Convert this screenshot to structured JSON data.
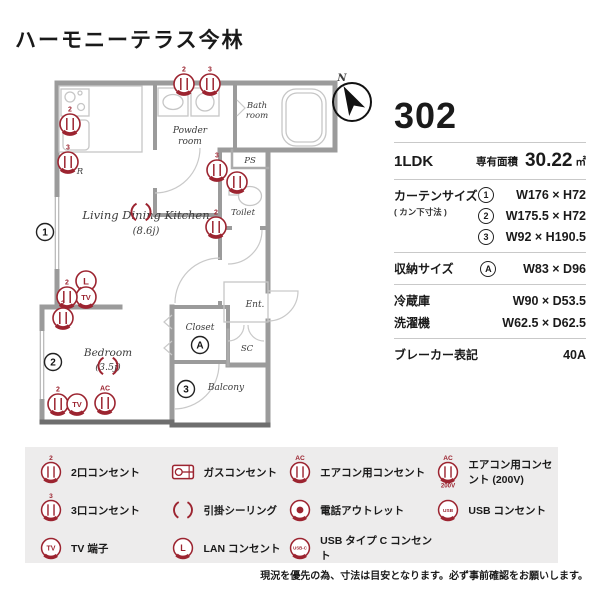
{
  "title": "ハーモニーテラス今林",
  "unit": {
    "number": "302",
    "layout": "1LDK",
    "area_label": "専有面積",
    "area_value": "30.22",
    "area_unit": "㎡",
    "curtain_label": "カーテンサイズ",
    "curtain_note": "( カン下寸法 )",
    "curtains": [
      {
        "mark": "1",
        "value": "W176 × H72"
      },
      {
        "mark": "2",
        "value": "W175.5 × H72"
      },
      {
        "mark": "3",
        "value": "W92 × H190.5"
      }
    ],
    "storage_label": "収納サイズ",
    "storage_mark": "A",
    "storage_value": "W83 × D96",
    "fridge_label": "冷蔵庫",
    "fridge_value": "W90 × D53.5",
    "washer_label": "洗濯機",
    "washer_value": "W62.5 × D62.5",
    "breaker_label": "ブレーカー表記",
    "breaker_value": "40A"
  },
  "plan": {
    "ldk_name": "Living Dining Kitchen",
    "ldk_size": "(8.6j)",
    "bedroom_name": "Bedroom",
    "bedroom_size": "(3.5j)",
    "powder_1": "Powder",
    "powder_2": "room",
    "bath_1": "Bath",
    "bath_2": "room",
    "toilet": "Toilet",
    "closet": "Closet",
    "balcony": "Balcony",
    "entrance": "Ent.",
    "ps": "PS",
    "sc": "SC",
    "marks": {
      "m1": "1",
      "m2": "2",
      "m3": "3",
      "ma": "A"
    },
    "compass": "N"
  },
  "glyphs": {
    "g2": "2",
    "g3": "3",
    "ac": "AC",
    "v200": "200V",
    "tv": "TV",
    "lan": "L",
    "usb": "USB",
    "usbc": "USB-C",
    "r": "R"
  },
  "legend": {
    "items": [
      {
        "glyph": "2",
        "label": "2口コンセント"
      },
      {
        "glyph": "3",
        "label": "3口コンセント"
      },
      {
        "glyph": "TV",
        "label": "TV 端子"
      },
      {
        "label": "ガスコンセント"
      },
      {
        "label": "引掛シーリング"
      },
      {
        "glyph": "L",
        "label": "LAN コンセント"
      },
      {
        "glyph": "AC",
        "label": "エアコン用コンセント"
      },
      {
        "label": "電話アウトレット"
      },
      {
        "glyph": "USB-C",
        "label": "USB タイプ C コンセント"
      },
      {
        "glyph": "AC",
        "sub": "200V",
        "label": "エアコン用コンセント (200V)"
      },
      {
        "glyph": "USB",
        "label": "USB コンセント"
      }
    ]
  },
  "disclaimer": "現況を優先の為、寸法は目安となります。必ず事前確認をお願いします。",
  "colors": {
    "accent": "#9c2430",
    "wall": "#9b9b9b"
  }
}
